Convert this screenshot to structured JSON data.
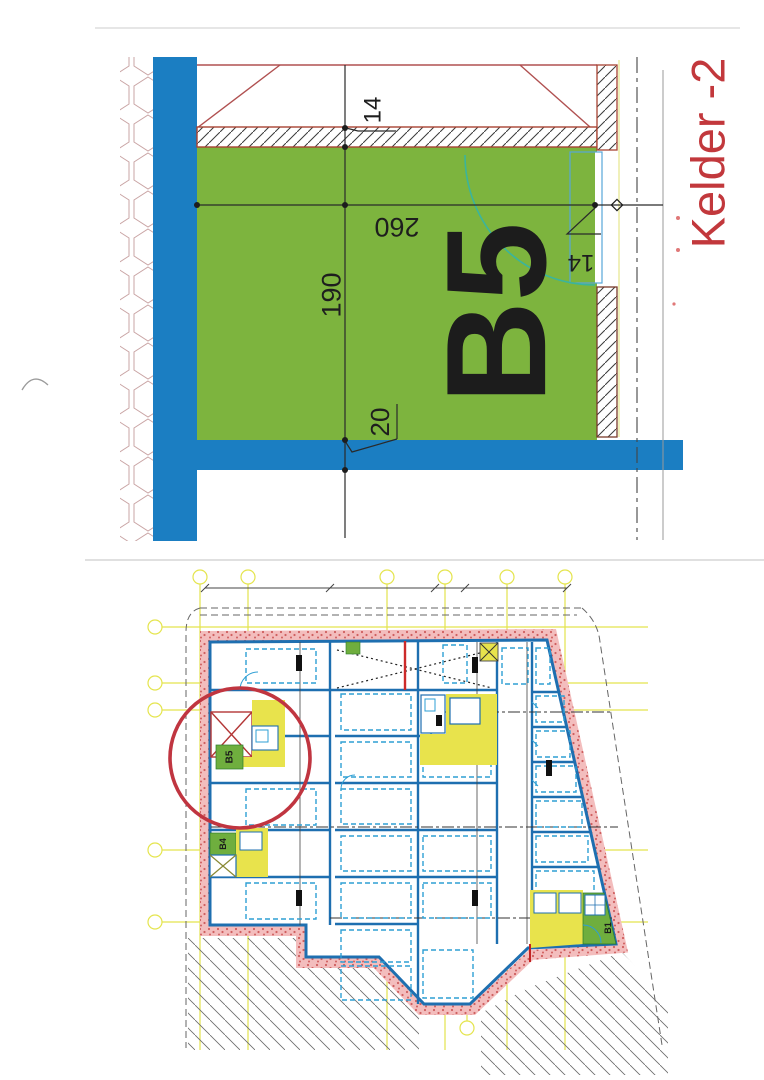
{
  "document": {
    "kind": "scanned basement floor plan, two stacked drawings",
    "floor_title": "Kelder -2"
  },
  "title": {
    "text": "Kelder -2",
    "color": "#c2383c"
  },
  "detail": {
    "room_label": "B5",
    "dims": {
      "width": "260",
      "depth": "190",
      "wall_thickness": "20",
      "wall_top": "14",
      "door_niche": "14"
    },
    "colors": {
      "room_fill": "#7db43e",
      "wall_blue": "#1b7ec2",
      "door_arc": "#3bb49c",
      "hatch_border": "#a84332"
    }
  },
  "overview": {
    "labels": {
      "b5": "B5",
      "b4": "B4",
      "b1": "B1"
    },
    "highlight_circle_color": "#c03540",
    "colors": {
      "grid_yellow": "#e2e23a",
      "band_pink": "#f3bdbd",
      "wall_blue": "#1e6fb0",
      "room_green": "#6fae3e",
      "room_yellow": "#e8e34c"
    }
  }
}
